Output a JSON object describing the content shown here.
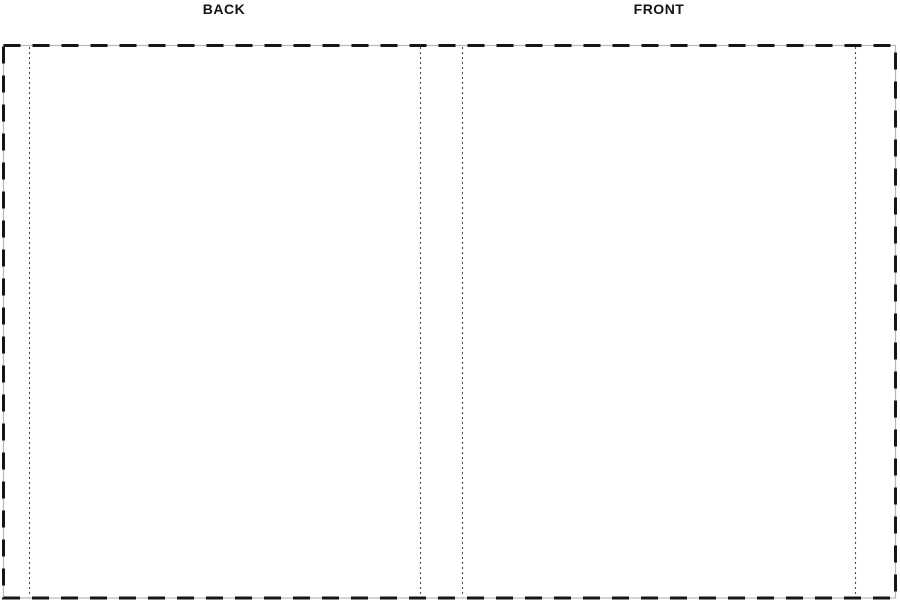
{
  "labels": {
    "back": "BACK",
    "front": "FRONT"
  },
  "colors": {
    "background": "#ffffff",
    "label_text": "#141414",
    "border_dash": "#161616",
    "border_underlay": "#b9b9b9",
    "guide_dot": "#4d4d4d"
  },
  "template_guides": {
    "outer_bleed_rect": {
      "x": 3,
      "y": 45,
      "width": 893,
      "height": 553
    },
    "vertical_guides": [
      {
        "name": "back-trim-line",
        "x": 29
      },
      {
        "name": "spine-left-fold-line",
        "x": 420
      },
      {
        "name": "spine-right-fold-line",
        "x": 462
      },
      {
        "name": "front-trim-line",
        "x": 855
      }
    ],
    "panels": [
      {
        "name": "back-cover",
        "label": "BACK"
      },
      {
        "name": "spine",
        "label": ""
      },
      {
        "name": "front-cover",
        "label": "FRONT"
      }
    ]
  }
}
